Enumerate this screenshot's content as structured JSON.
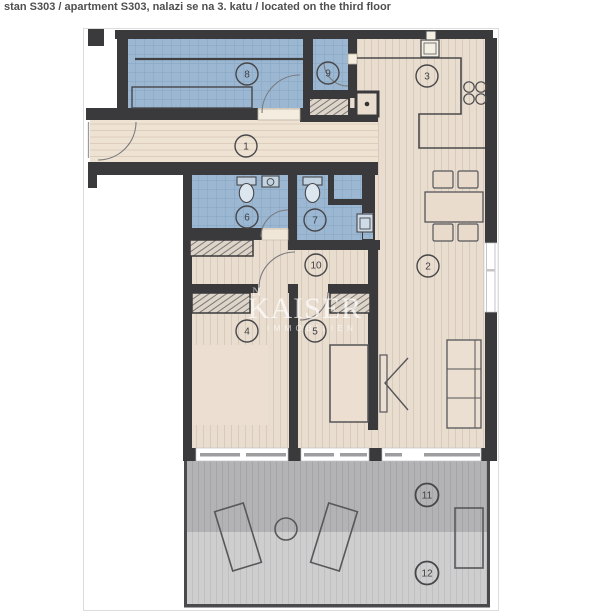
{
  "header": {
    "title": "stan S303 / apartment S303, nalazi se na 3. katu / located on the third floor"
  },
  "watermark": {
    "brand": "KAISER",
    "tagline": "IMMOBILIEN",
    "fragment": "N"
  },
  "markers": {
    "m1": "1",
    "m2": "2",
    "m3": "3",
    "m4": "4",
    "m5": "5",
    "m6": "6",
    "m7": "7",
    "m8": "8",
    "m9": "9",
    "m10": "10",
    "m11": "11",
    "m12": "12"
  },
  "colors": {
    "wall": "#3a3a3c",
    "tiled_room_blue": "#9bb7d2",
    "wood_floor_beige": "#e9ddcf",
    "hall_floor_beige": "#eee2d3",
    "terrace_covered_grey": "#b3b3b5",
    "terrace_open_grey": "#cecece",
    "marker_outline": "#47474a",
    "title_text": "#4f4f4f",
    "watermark": "#ffffff"
  }
}
